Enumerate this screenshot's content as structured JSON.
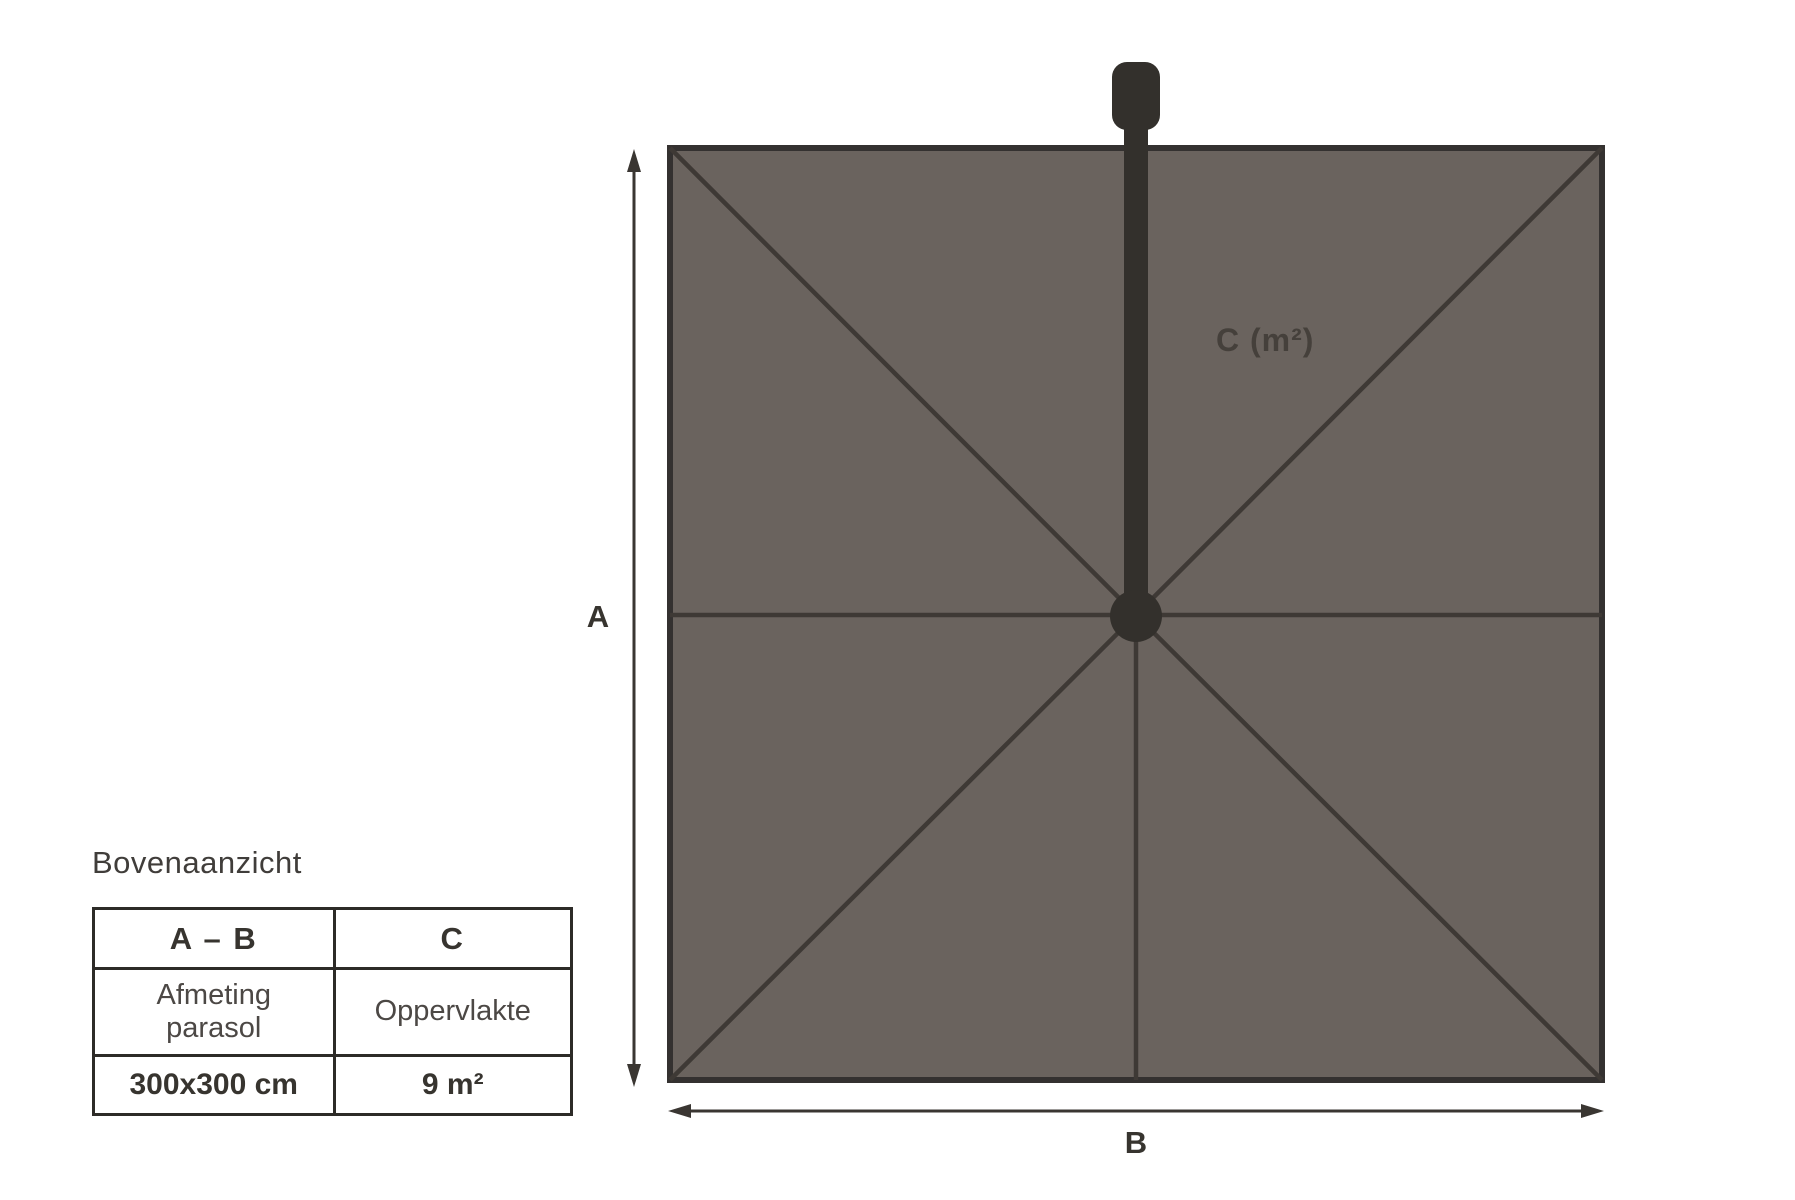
{
  "title": "Bovenaanzicht",
  "table": {
    "headers": [
      "A – B",
      "C"
    ],
    "rows": [
      [
        "Afmeting\nparasol",
        "Oppervlakte"
      ],
      [
        "300x300 cm",
        "9 m²"
      ]
    ]
  },
  "diagram": {
    "dim_a_label": "A",
    "dim_b_label": "B",
    "area_label": "C (m²)",
    "colors": {
      "canopy": "#6A635E",
      "rib": "#3E3935",
      "frame": "#343130",
      "pole": "#33302C",
      "arrow": "#3A3632",
      "table_border": "#2D2B28"
    }
  }
}
